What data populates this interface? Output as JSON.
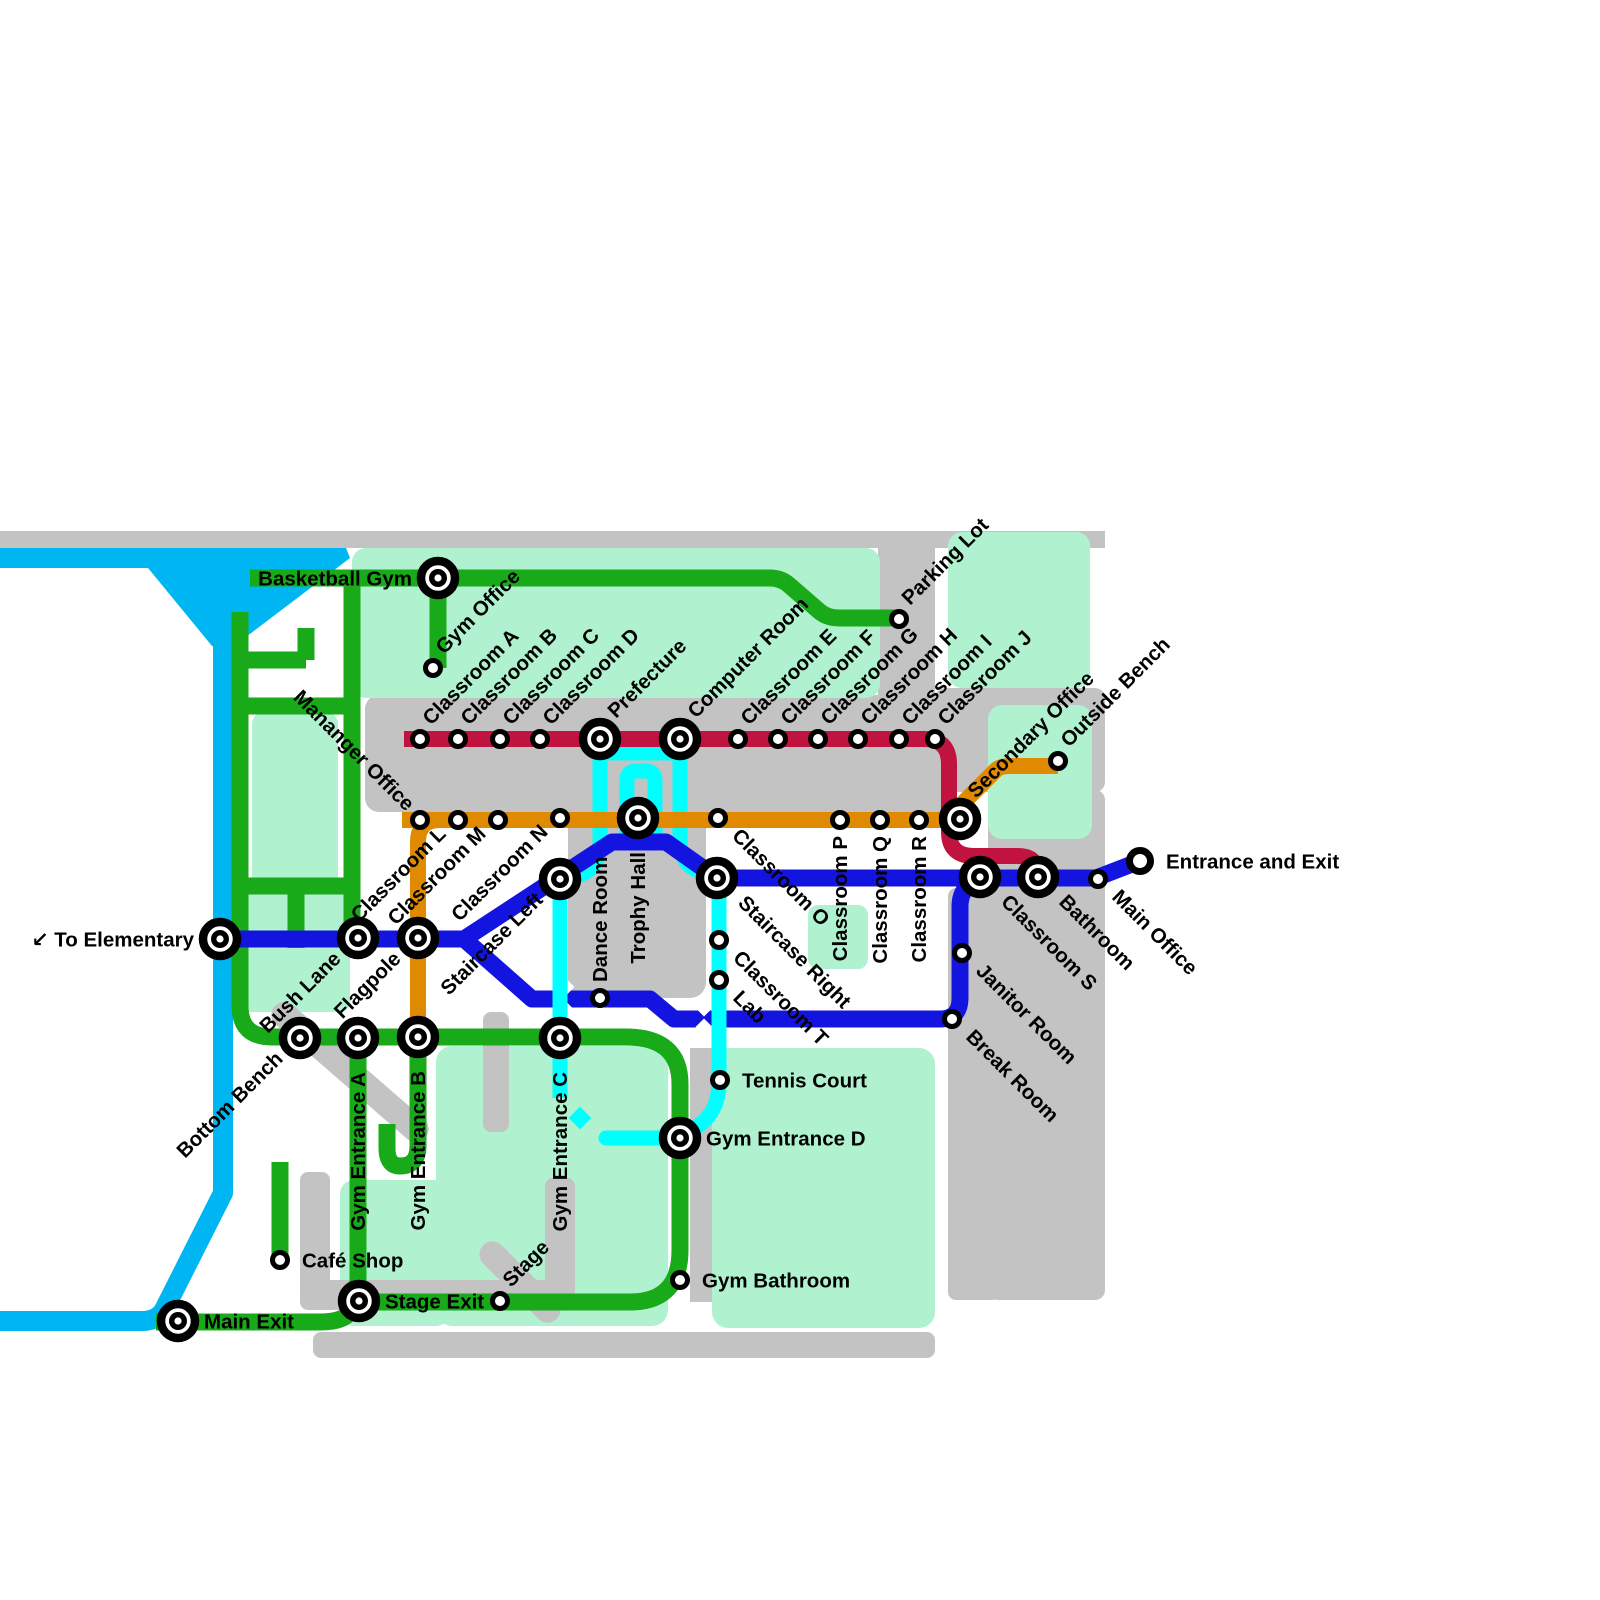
{
  "map": {
    "colors": {
      "background": "#ffffff",
      "grey": "#c3c3c3",
      "mint": "#b0f2cf",
      "river": "#00b6f2",
      "green": "#18aa18",
      "orange": "#df8a00",
      "crimson": "#c01340",
      "blue": "#1414e0",
      "cyan": "#00ffff",
      "station_stroke": "#000000",
      "station_fill": "#ffffff"
    },
    "backgrounds": [
      {
        "id": "top-band",
        "fill": "grey",
        "x": 0,
        "y": 531,
        "w": 1105,
        "h": 17,
        "rx": 0
      },
      {
        "id": "parking-road",
        "fill": "grey",
        "x": 878,
        "y": 548,
        "w": 57,
        "h": 150,
        "rx": 0
      },
      {
        "id": "classroom-band",
        "fill": "grey",
        "x": 365,
        "y": 695,
        "w": 592,
        "h": 117,
        "rx": 14
      },
      {
        "id": "trophy-block",
        "fill": "grey",
        "x": 568,
        "y": 750,
        "w": 138,
        "h": 248,
        "rx": 16
      },
      {
        "id": "right-col-top",
        "fill": "grey",
        "x": 935,
        "y": 688,
        "w": 170,
        "h": 104,
        "rx": 10
      },
      {
        "id": "right-col",
        "fill": "grey",
        "x": 988,
        "y": 790,
        "w": 117,
        "h": 510,
        "rx": 10
      },
      {
        "id": "right-col-lower",
        "fill": "grey",
        "x": 948,
        "y": 888,
        "w": 52,
        "h": 412,
        "rx": 8
      },
      {
        "id": "mint-top-main",
        "fill": "mint",
        "x": 352,
        "y": 548,
        "w": 528,
        "h": 150,
        "rx": 14
      },
      {
        "id": "mint-top-right",
        "fill": "mint",
        "x": 948,
        "y": 532,
        "w": 142,
        "h": 156,
        "rx": 14
      },
      {
        "id": "mint-outside-bench",
        "fill": "mint",
        "x": 988,
        "y": 705,
        "w": 104,
        "h": 134,
        "rx": 14
      },
      {
        "id": "mint-loop-inner",
        "fill": "mint",
        "x": 252,
        "y": 712,
        "w": 86,
        "h": 178,
        "rx": 12
      },
      {
        "id": "mint-left-col",
        "fill": "mint",
        "x": 230,
        "y": 878,
        "w": 120,
        "h": 134,
        "rx": 10
      },
      {
        "id": "mint-gym-a",
        "fill": "mint",
        "x": 436,
        "y": 1046,
        "w": 232,
        "h": 280,
        "rx": 16
      },
      {
        "id": "mint-gym-b",
        "fill": "mint",
        "x": 340,
        "y": 1180,
        "w": 110,
        "h": 146,
        "rx": 14
      },
      {
        "id": "mint-gym-right",
        "fill": "mint",
        "x": 712,
        "y": 1048,
        "w": 223,
        "h": 280,
        "rx": 16
      },
      {
        "id": "mint-small-sq",
        "fill": "mint",
        "x": 808,
        "y": 905,
        "w": 60,
        "h": 64,
        "rx": 10
      },
      {
        "id": "road-gym-mid",
        "fill": "grey",
        "x": 690,
        "y": 1048,
        "w": 22,
        "h": 254,
        "rx": 0
      },
      {
        "id": "bottom-band",
        "fill": "grey",
        "x": 313,
        "y": 1332,
        "w": 622,
        "h": 26,
        "rx": 8
      },
      {
        "id": "road-cafe-v1",
        "fill": "grey",
        "x": 300,
        "y": 1172,
        "w": 30,
        "h": 136,
        "rx": 8
      },
      {
        "id": "road-cafe-h",
        "fill": "grey",
        "x": 300,
        "y": 1280,
        "w": 272,
        "h": 30,
        "rx": 8
      },
      {
        "id": "road-cafe-v2",
        "fill": "grey",
        "x": 545,
        "y": 1178,
        "w": 30,
        "h": 124,
        "rx": 8
      },
      {
        "id": "road-geb",
        "fill": "grey",
        "x": 483,
        "y": 1012,
        "w": 26,
        "h": 120,
        "rx": 8
      }
    ],
    "rot_roads": [
      {
        "id": "road-diag-bench",
        "fill": "grey",
        "cx": 350,
        "cy": 1072,
        "len": 200,
        "w": 26,
        "angle": 41
      },
      {
        "id": "road-diag-cafe",
        "fill": "grey",
        "cx": 520,
        "cy": 1282,
        "len": 104,
        "w": 26,
        "angle": 45
      }
    ],
    "river": {
      "id": "elementary-river",
      "wedge_points": "0,548 346,548 350,558 234,646 212,646 148,568 0,568",
      "path": "M223 640 V1193 L166 1306 Q160 1321 142 1321 H-6",
      "width": 20
    },
    "lines": [
      {
        "id": "cyan-top-bar",
        "color": "cyan",
        "width": 15,
        "d": "M600 753 H680"
      },
      {
        "id": "cyan-prefecture-down",
        "color": "cyan",
        "width": 15,
        "d": "M600 747 V843 Q600 872 572 877"
      },
      {
        "id": "cyan-staircase-left-down",
        "color": "cyan",
        "width": 15,
        "d": "M560 886 V1098"
      },
      {
        "id": "cyan-trophy-ring",
        "color": "cyan",
        "width": 15,
        "d": "M627 848 V780 Q627 771 637 771 H645 Q655 771 655 780 V848"
      },
      {
        "id": "cyan-computer-down",
        "color": "cyan",
        "width": 15,
        "d": "M680 747 V840 Q680 866 702 872 L714 876"
      },
      {
        "id": "cyan-classrooms-down",
        "color": "cyan",
        "width": 15,
        "d": "M719 886 V1082 Q719 1107 704 1121 L690 1133"
      },
      {
        "id": "cyan-ged-stub",
        "color": "cyan",
        "width": 15,
        "cap": "round",
        "d": "M664 1138 H606"
      },
      {
        "id": "gapset-a",
        "gaps": [
          [
            627,
            820,
            13
          ],
          [
            655,
            820,
            13
          ]
        ]
      },
      {
        "id": "green-main-loop",
        "color": "green",
        "width": 17,
        "d": "M240 612 V1006 Q240 1037 272 1037 H626 Q680 1037 680 1084 V1250 Q680 1302 630 1302 H380 Q357 1302 351 1311 Q344 1322 320 1322 H156"
      },
      {
        "id": "green-gym-a-vert",
        "color": "green",
        "width": 17,
        "d": "M358 1037 V1302"
      },
      {
        "id": "green-gym-b-hook",
        "color": "green",
        "width": 17,
        "d": "M418 1037 V1146 Q418 1166 400 1166 Q387 1166 387 1148 V1124"
      },
      {
        "id": "green-top-line",
        "color": "green",
        "width": 17,
        "d": "M250 578 H770 Q781 578 789 585 L819 611 Q827 618 839 618 H899"
      },
      {
        "id": "green-gym-office-stub",
        "color": "green",
        "width": 17,
        "d": "M438 578 V668"
      },
      {
        "id": "green-bushlane-vert",
        "color": "green",
        "width": 17,
        "d": "M352 578 V938"
      },
      {
        "id": "green-conn-top",
        "color": "green",
        "width": 17,
        "d": "M240 706 H352"
      },
      {
        "id": "green-conn-bottom",
        "color": "green",
        "width": 17,
        "d": "M240 886 H352"
      },
      {
        "id": "green-stub",
        "color": "green",
        "width": 17,
        "d": "M296 886 V948"
      },
      {
        "id": "green-stair-h",
        "color": "green",
        "width": 17,
        "d": "M240 660 H306"
      },
      {
        "id": "green-stair-v",
        "color": "green",
        "width": 17,
        "d": "M306 628 V660"
      },
      {
        "id": "green-cafe-stub",
        "color": "green",
        "width": 17,
        "d": "M280 1162 V1260"
      },
      {
        "id": "orange-main",
        "color": "orange",
        "width": 16,
        "d": "M402 820 H946 L996 770 Q1000 766 1010 766 H1058"
      },
      {
        "id": "orange-vert",
        "color": "orange",
        "width": 16,
        "d": "M418 1037 V842 Q418 820 440 820"
      },
      {
        "id": "crimson-main",
        "color": "crimson",
        "width": 16,
        "d": "M404 739 H924 Q949 739 949 764 V832 Q949 856 974 856 H1018 Q1032 856 1036 866 L1039 874"
      },
      {
        "id": "blue-main",
        "color": "blue",
        "width": 17,
        "d": "M205 939 H464 L612 842 H666 L717 878 H1096 L1140 861"
      },
      {
        "id": "blue-loop",
        "color": "blue",
        "width": 17,
        "d": "M464 939 L532 999 H650 L674 1019 H940 Q960 1019 960 998 V906 Q960 890 974 880"
      },
      {
        "id": "gapset-b",
        "gaps": [
          [
            566,
            987,
            12
          ],
          [
            566,
            1010,
            12
          ],
          [
            704,
            1008,
            12
          ],
          [
            704,
            1027,
            12
          ]
        ]
      },
      {
        "id": "cyan-over-1",
        "color": "cyan",
        "width": 15,
        "d": "M560 976 V1022"
      },
      {
        "id": "cyan-over-2",
        "color": "cyan",
        "width": 15,
        "d": "M719 998 V1040"
      }
    ],
    "decor_diamonds": [
      {
        "id": "cyan-diamond",
        "color": "cyan",
        "x": 580,
        "y": 1118,
        "size": 16
      }
    ],
    "stations": [
      {
        "id": "basketball-gym",
        "x": 438,
        "y": 578,
        "kind": "big",
        "label": "Basketball Gym",
        "mode": "hl"
      },
      {
        "id": "gym-office",
        "x": 433,
        "y": 668,
        "kind": "small",
        "label": "Gym Office",
        "mode": "du"
      },
      {
        "id": "parking-lot",
        "x": 899,
        "y": 619,
        "kind": "small",
        "label": "Parking Lot",
        "mode": "du"
      },
      {
        "id": "classroom-a",
        "x": 420,
        "y": 739,
        "kind": "small",
        "label": "Classroom A",
        "mode": "du"
      },
      {
        "id": "classroom-b",
        "x": 458,
        "y": 739,
        "kind": "small",
        "label": "Classroom B",
        "mode": "du"
      },
      {
        "id": "classroom-c",
        "x": 500,
        "y": 739,
        "kind": "small",
        "label": "Classroom C",
        "mode": "du"
      },
      {
        "id": "classroom-d",
        "x": 540,
        "y": 739,
        "kind": "small",
        "label": "Classroom D",
        "mode": "du"
      },
      {
        "id": "prefecture",
        "x": 600,
        "y": 739,
        "kind": "big",
        "label": "Prefecture",
        "mode": "du"
      },
      {
        "id": "computer-room",
        "x": 680,
        "y": 739,
        "kind": "big",
        "label": "Computer Room",
        "mode": "du"
      },
      {
        "id": "classroom-e",
        "x": 738,
        "y": 739,
        "kind": "small",
        "label": "Classroom E",
        "mode": "du"
      },
      {
        "id": "classroom-f",
        "x": 778,
        "y": 739,
        "kind": "small",
        "label": "Classroom F",
        "mode": "du"
      },
      {
        "id": "classroom-g",
        "x": 818,
        "y": 739,
        "kind": "small",
        "label": "Classroom G",
        "mode": "du"
      },
      {
        "id": "classroom-h",
        "x": 858,
        "y": 739,
        "kind": "small",
        "label": "Classroom H",
        "mode": "du"
      },
      {
        "id": "classroom-i",
        "x": 899,
        "y": 739,
        "kind": "small",
        "label": "Classroom I",
        "mode": "du"
      },
      {
        "id": "classroom-j",
        "x": 935,
        "y": 739,
        "kind": "small",
        "label": "Classroom J",
        "mode": "du"
      },
      {
        "id": "secondary-office",
        "x": 960,
        "y": 819,
        "kind": "big",
        "label": "Secondary Office",
        "mode": "du"
      },
      {
        "id": "outside-bench",
        "x": 1058,
        "y": 761,
        "kind": "small",
        "label": "Outside Bench",
        "mode": "du"
      },
      {
        "id": "mananger-office",
        "x": 420,
        "y": 820,
        "kind": "small",
        "label": "Mananger Office",
        "mode": "dde"
      },
      {
        "id": "classroom-l",
        "x": 458,
        "y": 820,
        "kind": "small",
        "label": "Classroom L",
        "mode": "due"
      },
      {
        "id": "classroom-m",
        "x": 498,
        "y": 820,
        "kind": "small",
        "label": "Classroom M",
        "mode": "due"
      },
      {
        "id": "classroom-n",
        "x": 560,
        "y": 818,
        "kind": "small",
        "label": "Classroom N",
        "mode": "due"
      },
      {
        "id": "trophy-hall",
        "x": 638,
        "y": 818,
        "kind": "big",
        "label": "Trophy Hall",
        "mode": "vd"
      },
      {
        "id": "classroom-o",
        "x": 718,
        "y": 818,
        "kind": "small",
        "label": "Classroom O",
        "mode": "dd"
      },
      {
        "id": "classroom-p",
        "x": 840,
        "y": 820,
        "kind": "small",
        "label": "Classroom P",
        "mode": "vd"
      },
      {
        "id": "classroom-q",
        "x": 880,
        "y": 820,
        "kind": "small",
        "label": "Classroom Q",
        "mode": "vd"
      },
      {
        "id": "classroom-r",
        "x": 919,
        "y": 820,
        "kind": "small",
        "label": "Classroom R",
        "mode": "vd"
      },
      {
        "id": "to-elementary",
        "x": 220,
        "y": 939,
        "kind": "big",
        "label": "↙ To Elementary",
        "mode": "hl"
      },
      {
        "id": "bush-lane",
        "x": 358,
        "y": 938,
        "kind": "big",
        "label": "Bush Lane",
        "mode": "due"
      },
      {
        "id": "flagpole",
        "x": 418,
        "y": 938,
        "kind": "big",
        "label": "Flagpole",
        "mode": "due"
      },
      {
        "id": "staircase-left",
        "x": 560,
        "y": 879,
        "kind": "big",
        "label": "Staircase Left",
        "mode": "due"
      },
      {
        "id": "staircase-right",
        "x": 717,
        "y": 878,
        "kind": "big",
        "label": "Staircase Right",
        "mode": "dd"
      },
      {
        "id": "dance-room",
        "x": 600,
        "y": 998,
        "kind": "small",
        "label": "Dance Room",
        "mode": "vu"
      },
      {
        "id": "classroom-t",
        "x": 719,
        "y": 940,
        "kind": "small",
        "label": "Classroom T",
        "mode": "dd"
      },
      {
        "id": "lab",
        "x": 719,
        "y": 980,
        "kind": "small",
        "label": "Lab",
        "mode": "dd"
      },
      {
        "id": "classroom-s",
        "x": 980,
        "y": 877,
        "kind": "big",
        "label": "Classroom S",
        "mode": "dd"
      },
      {
        "id": "bathroom",
        "x": 1038,
        "y": 877,
        "kind": "big",
        "label": "Bathroom",
        "mode": "dd"
      },
      {
        "id": "main-office",
        "x": 1098,
        "y": 879,
        "kind": "small",
        "label": "Main Office",
        "mode": "dd"
      },
      {
        "id": "entrance-and-exit",
        "x": 1140,
        "y": 861,
        "kind": "terminus",
        "label": "Entrance and Exit",
        "mode": "hr"
      },
      {
        "id": "janitor-room",
        "x": 962,
        "y": 953,
        "kind": "small",
        "label": "Janitor Room",
        "mode": "dd"
      },
      {
        "id": "break-room",
        "x": 952,
        "y": 1019,
        "kind": "small",
        "label": "Break Room",
        "mode": "dd"
      },
      {
        "id": "bottom-bench",
        "x": 300,
        "y": 1038,
        "kind": "big",
        "label": "Bottom Bench",
        "mode": "due"
      },
      {
        "id": "gym-entrance-a",
        "x": 358,
        "y": 1038,
        "kind": "big",
        "label": "Gym Entrance A",
        "mode": "vd"
      },
      {
        "id": "gym-entrance-b",
        "x": 418,
        "y": 1037,
        "kind": "big",
        "label": "Gym Entrance B",
        "mode": "vd"
      },
      {
        "id": "gym-entrance-c",
        "x": 560,
        "y": 1038,
        "kind": "big",
        "label": "Gym Entrance C",
        "mode": "vd"
      },
      {
        "id": "tennis-court",
        "x": 720,
        "y": 1080,
        "kind": "small",
        "label": "Tennis Court",
        "mode": "hr"
      },
      {
        "id": "gym-entrance-d",
        "x": 680,
        "y": 1138,
        "kind": "big",
        "label": "Gym Entrance D",
        "mode": "hr"
      },
      {
        "id": "gym-bathroom",
        "x": 680,
        "y": 1280,
        "kind": "small",
        "label": "Gym Bathroom",
        "mode": "hr"
      },
      {
        "id": "cafe-shop",
        "x": 280,
        "y": 1260,
        "kind": "small",
        "label": "Café Shop",
        "mode": "hr"
      },
      {
        "id": "stage",
        "x": 500,
        "y": 1301,
        "kind": "small",
        "label": "Stage",
        "mode": "du"
      },
      {
        "id": "stage-exit",
        "x": 359,
        "y": 1301,
        "kind": "big",
        "label": "Stage Exit",
        "mode": "hr"
      },
      {
        "id": "main-exit",
        "x": 178,
        "y": 1321,
        "kind": "big",
        "label": "Main Exit",
        "mode": "hr"
      }
    ]
  }
}
